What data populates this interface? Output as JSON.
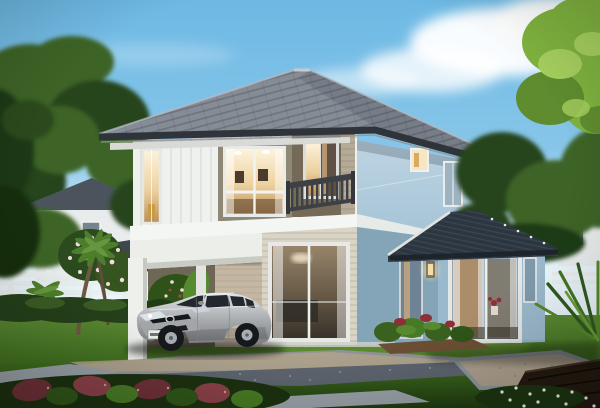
{
  "scene": {
    "description": "Daytime photorealistic rendering of a modern two-story house with gray hipped tile roof, white and light-blue walls, an upstairs balcony, an open carport sheltering a silver hatchback car, a single-story glass sunroom extension with dark roof, manicured lawn, hedges, palm trees, flowering shrubs, stone paths and a wooden deck, under a blue sky with white clouds.",
    "elements": [
      "sky",
      "clouds",
      "neighbor-houses",
      "white-fence",
      "palm-trees",
      "plumeria-tree",
      "main-house",
      "balcony",
      "carport",
      "silver-hatchback-car",
      "sunroom-extension",
      "wall-lamp",
      "lawn",
      "driveway",
      "gravel-pad",
      "wood-deck",
      "shrubs",
      "daisies",
      "right-tree"
    ]
  },
  "colors": {
    "sky_top": "#6db9e4",
    "cloud": "#ffffff",
    "roof_mid": "#868c96",
    "fascia_dark": "#2e343a",
    "soffit": "#d9dad6",
    "siding_white": "#eff1ef",
    "siding_tan": "#b5aa97",
    "window_surround": "#8f8877",
    "glass_warm": "#f3e2c2",
    "glass_warm_deep": "#c89a5e",
    "glass_cool": "#9db3c2",
    "recess_shade": "#756a58",
    "railing_dark": "#3d4145",
    "band_white": "#f4f6f4",
    "wall_blue_light": "#c6deec",
    "wall_blue": "#9fc0d4",
    "ext_wall": "#9bb9cc",
    "ext_wall_shade": "#84a4b8",
    "ext_roof": "#2c3640",
    "column_white": "#eef0ec",
    "siding_cream": "#d9d4c6",
    "carport_wall": "#c3b7a2",
    "car_silver": "#b5b7b9",
    "car_glass": "#23282e",
    "tyre_dark": "#16191c",
    "grass_light": "#72a040",
    "grass_mid": "#42701f",
    "grass_dark": "#234514",
    "hedge_dark": "#24401a",
    "tree_bright": "#7fb23f",
    "tree_light": "#a5cf5e",
    "tree_mid": "#3d6326",
    "tree_dark": "#27441d",
    "palm_green": "#4e7e2c",
    "trunk_brown": "#6b5942",
    "flower_pink": "#f0dbde",
    "flower_red": "#8e2f36",
    "pavement_gray": "#8f9398",
    "path_warm": "#b1a38a",
    "gravel_blue": "#5d646e",
    "slab_gray": "#98a0a7",
    "deck_dark": "#241a10",
    "fence_white": "#e9eeee",
    "neighbor_roof": "#4b545c",
    "neighbor_wall": "#e8ecec",
    "lamp_glow": "#f7dda4"
  }
}
